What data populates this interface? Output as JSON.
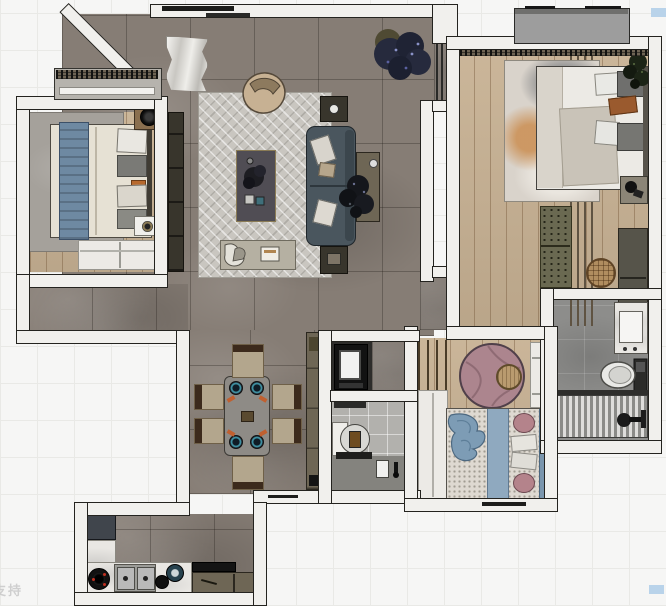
{
  "watermark": {
    "text": "支持"
  },
  "colors": {
    "bg": "#f6f6f5",
    "grid": "#e9e9e6",
    "wall_fill": "#f1f0ed",
    "wall_line": "#24231f",
    "floor_tile": "#867d75",
    "wood": "#c8b294",
    "rug_living": "#c9c6c0",
    "rug_gray": "#a5a19b",
    "sofa": "#4a565e",
    "coffee_table": "#504d54",
    "table_edge": "#8a7b55",
    "olive": "#6e6655",
    "dark_unit": "#38352c",
    "bed_duvet": "#e6e1d4",
    "throw_blue": "#6e89a2",
    "master_duvet": "#eceae5",
    "pillow_dark": "#6f6f6d",
    "pillow_orange": "#9a5a2e",
    "runner_green": "#6a6951",
    "basket": "#b08d5f",
    "mauve_rug": "#ac858e",
    "pouf": "#b99b6f",
    "kids_blue": "#8fa9bf",
    "kids_blanket": "#7d9cb5",
    "pink_pillow": "#b4838b",
    "bath_tile": "#8d8d8b",
    "bath2_tile": "#b2b1ad",
    "marble": "#e9e7e3",
    "fridge": "#40454c",
    "steel": "#b9b9b9",
    "burner_red": "#c03020",
    "balcony": "#9d9d9d",
    "plant_dark": "#262a3d",
    "artifact_blue": "#b9d3ea",
    "watermark": "#c9c9c9",
    "dining_table": "#8e8b86",
    "chair_seat": "#b3a68d",
    "chair_back": "#3c2a1c"
  }
}
